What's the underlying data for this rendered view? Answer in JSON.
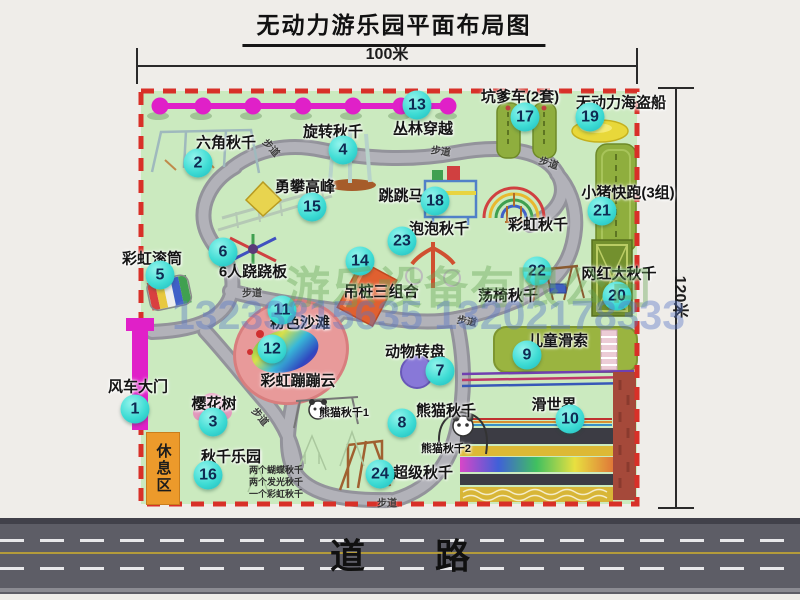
{
  "title": "无动力游乐园平面布局图",
  "dimensions": {
    "width_label": "100米",
    "height_label": "120米"
  },
  "road": {
    "label": "道　　路"
  },
  "watermark": {
    "company": "游乐设备有限公司",
    "phone": "13233815635 13202178333"
  },
  "rest_area": {
    "label": "休息区"
  },
  "path_label": "步道",
  "path_label_positions": [
    {
      "x": 272,
      "y": 147,
      "r": 48
    },
    {
      "x": 441,
      "y": 150,
      "r": 8
    },
    {
      "x": 549,
      "y": 162,
      "r": 18
    },
    {
      "x": 252,
      "y": 292,
      "r": 0
    },
    {
      "x": 467,
      "y": 320,
      "r": 10
    },
    {
      "x": 261,
      "y": 416,
      "r": 50
    },
    {
      "x": 387,
      "y": 502,
      "r": 0
    }
  ],
  "attractions": [
    {
      "num": "1",
      "name": "风车大门",
      "bx": 135,
      "by": 409,
      "lx": 138,
      "ly": 386
    },
    {
      "num": "2",
      "name": "六角秋千",
      "bx": 198,
      "by": 163,
      "lx": 226,
      "ly": 142
    },
    {
      "num": "3",
      "name": "樱花树",
      "bx": 213,
      "by": 422,
      "lx": 214,
      "ly": 403
    },
    {
      "num": "4",
      "name": "旋转秋千",
      "bx": 343,
      "by": 150,
      "lx": 333,
      "ly": 131
    },
    {
      "num": "5",
      "name": "彩虹滚筒",
      "bx": 160,
      "by": 275,
      "lx": 152,
      "ly": 258
    },
    {
      "num": "6",
      "name": "6人跷跷板",
      "bx": 223,
      "by": 252,
      "lx": 253,
      "ly": 271
    },
    {
      "num": "7",
      "name": "动物转盘",
      "bx": 440,
      "by": 371,
      "lx": 415,
      "ly": 351
    },
    {
      "num": "8",
      "name": "熊猫秋千",
      "bx": 402,
      "by": 423,
      "lx": 446,
      "ly": 410
    },
    {
      "num": "9",
      "name": "儿童滑索",
      "bx": 527,
      "by": 355,
      "lx": 558,
      "ly": 340
    },
    {
      "num": "10",
      "name": "滑世界",
      "bx": 570,
      "by": 419,
      "lx": 554,
      "ly": 404
    },
    {
      "num": "11",
      "name": "粉色沙滩",
      "bx": 282,
      "by": 310,
      "lx": 300,
      "ly": 322
    },
    {
      "num": "12",
      "name": "彩虹蹦蹦云",
      "bx": 272,
      "by": 349,
      "lx": 298,
      "ly": 380
    },
    {
      "num": "13",
      "name": "丛林穿越",
      "bx": 417,
      "by": 105,
      "lx": 423,
      "ly": 128
    },
    {
      "num": "14",
      "name": "吊桩三组合",
      "bx": 360,
      "by": 261,
      "lx": 381,
      "ly": 291
    },
    {
      "num": "15",
      "name": "勇攀高峰",
      "bx": 312,
      "by": 207,
      "lx": 305,
      "ly": 186
    },
    {
      "num": "16",
      "name": "秋千乐园",
      "bx": 208,
      "by": 475,
      "lx": 231,
      "ly": 456
    },
    {
      "num": "17",
      "name": "坑爹车(2套)",
      "bx": 525,
      "by": 117,
      "lx": 520,
      "ly": 96
    },
    {
      "num": "18",
      "name": "跳跳马",
      "bx": 435,
      "by": 201,
      "lx": 401,
      "ly": 195
    },
    {
      "num": "19",
      "name": "无动力海盗船",
      "bx": 590,
      "by": 117,
      "lx": 621,
      "ly": 102
    },
    {
      "num": "20",
      "name": "网红大秋千",
      "bx": 617,
      "by": 296,
      "lx": 619,
      "ly": 273
    },
    {
      "num": "21",
      "name": "小猪快跑(3组)",
      "bx": 602,
      "by": 211,
      "lx": 628,
      "ly": 192
    },
    {
      "num": "22",
      "name": "荡椅秋千",
      "bx": 537,
      "by": 271,
      "lx": 508,
      "ly": 295
    },
    {
      "num": "23",
      "name": "泡泡秋千",
      "bx": 402,
      "by": 241,
      "lx": 439,
      "ly": 228
    },
    {
      "num": "24",
      "name": "超级秋千",
      "bx": 380,
      "by": 474,
      "lx": 423,
      "ly": 472
    }
  ],
  "extra_labels": [
    {
      "text": "彩虹秋千",
      "x": 538,
      "y": 224,
      "small": false
    },
    {
      "text": "熊猫秋千1",
      "x": 344,
      "y": 412,
      "small": true
    },
    {
      "text": "熊猫秋千2",
      "x": 446,
      "y": 448,
      "small": true
    }
  ],
  "swing_park_notes": [
    "两个蝴蝶秋千",
    "两个发光秋千",
    "一个彩虹秋千"
  ],
  "colors": {
    "map_green": "#cbeabf",
    "border_red": "#d83028",
    "path_gray": "#a2a2aa",
    "magenta": "#e020c8",
    "badge_cyan": "#3edcd4",
    "rest_orange": "#ec9a2b",
    "road_gray": "#5d5d66"
  }
}
